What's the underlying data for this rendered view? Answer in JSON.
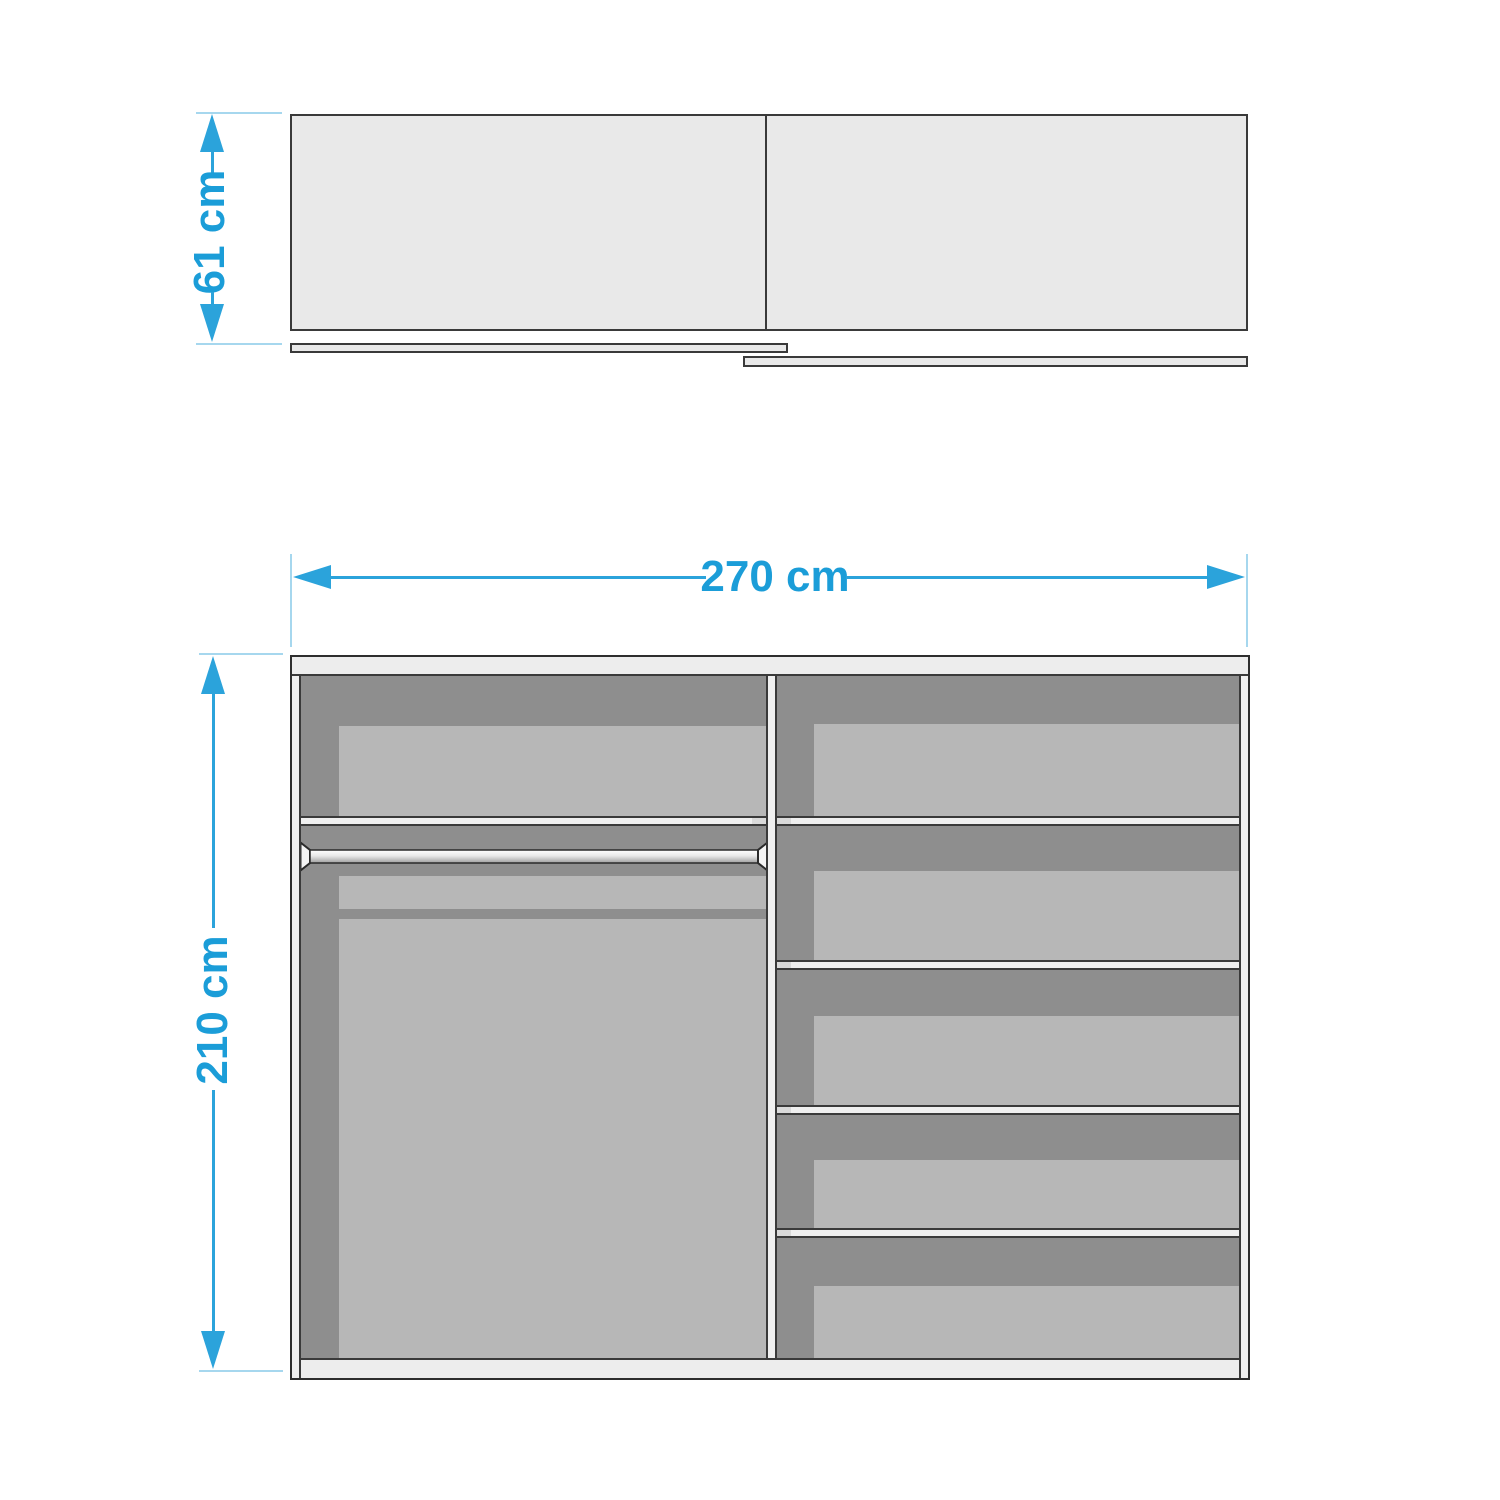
{
  "diagram": {
    "kind": "furniture dimension drawing",
    "subject": "sliding-door wardrobe, top view and front interior view"
  },
  "dimensions": {
    "depth": {
      "label": "61 cm"
    },
    "width": {
      "label": "270 cm"
    },
    "height": {
      "label": "210 cm"
    }
  },
  "colors": {
    "dimension_text": "#1B9DD8",
    "dimension_line": "#2BA3DB",
    "dimension_tick": "#A6D7EE",
    "outline": "#3A3A3A",
    "panel_light": "#EDEDED",
    "interior_dark": "#8E8E8E",
    "interior_panel": "#B7B7B7",
    "top_view_fill": "#E9E9E9",
    "background": "#FFFFFF"
  },
  "views": {
    "top_view": {
      "parts": [
        "cabinet body",
        "center divider",
        "left sliding door",
        "right sliding door"
      ]
    },
    "front_view": {
      "left_section": {
        "parts": [
          "shelf",
          "clothes rail",
          "hanging space"
        ]
      },
      "right_section": {
        "compartments": 5,
        "shelves": 4
      }
    }
  }
}
